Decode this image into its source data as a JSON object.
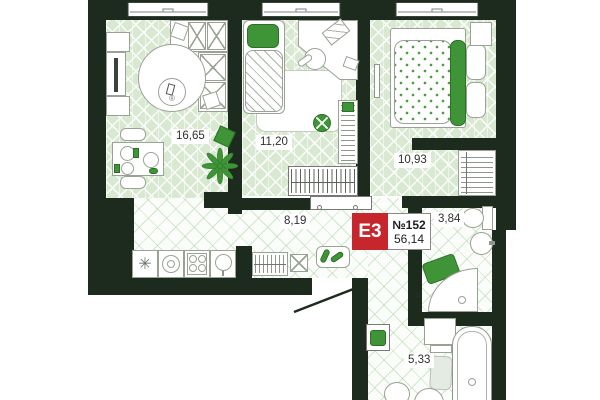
{
  "flat": {
    "type": "E3",
    "number": "№152",
    "total_area": "56,14"
  },
  "rooms": {
    "living": {
      "area": "16,65"
    },
    "child": {
      "area": "11,20"
    },
    "bedroom": {
      "area": "10,93"
    },
    "hall": {
      "area": "8,19"
    },
    "wc": {
      "area": "3,84"
    },
    "bathroom": {
      "area": "5,33"
    }
  },
  "symbols": {
    "fridge": "✳",
    "registered": "®"
  },
  "colors": {
    "wall": "#1c2b1e",
    "accent_red": "#c5272d",
    "furniture_green": "#3f9438",
    "floor_green": "#d9e8d1"
  }
}
